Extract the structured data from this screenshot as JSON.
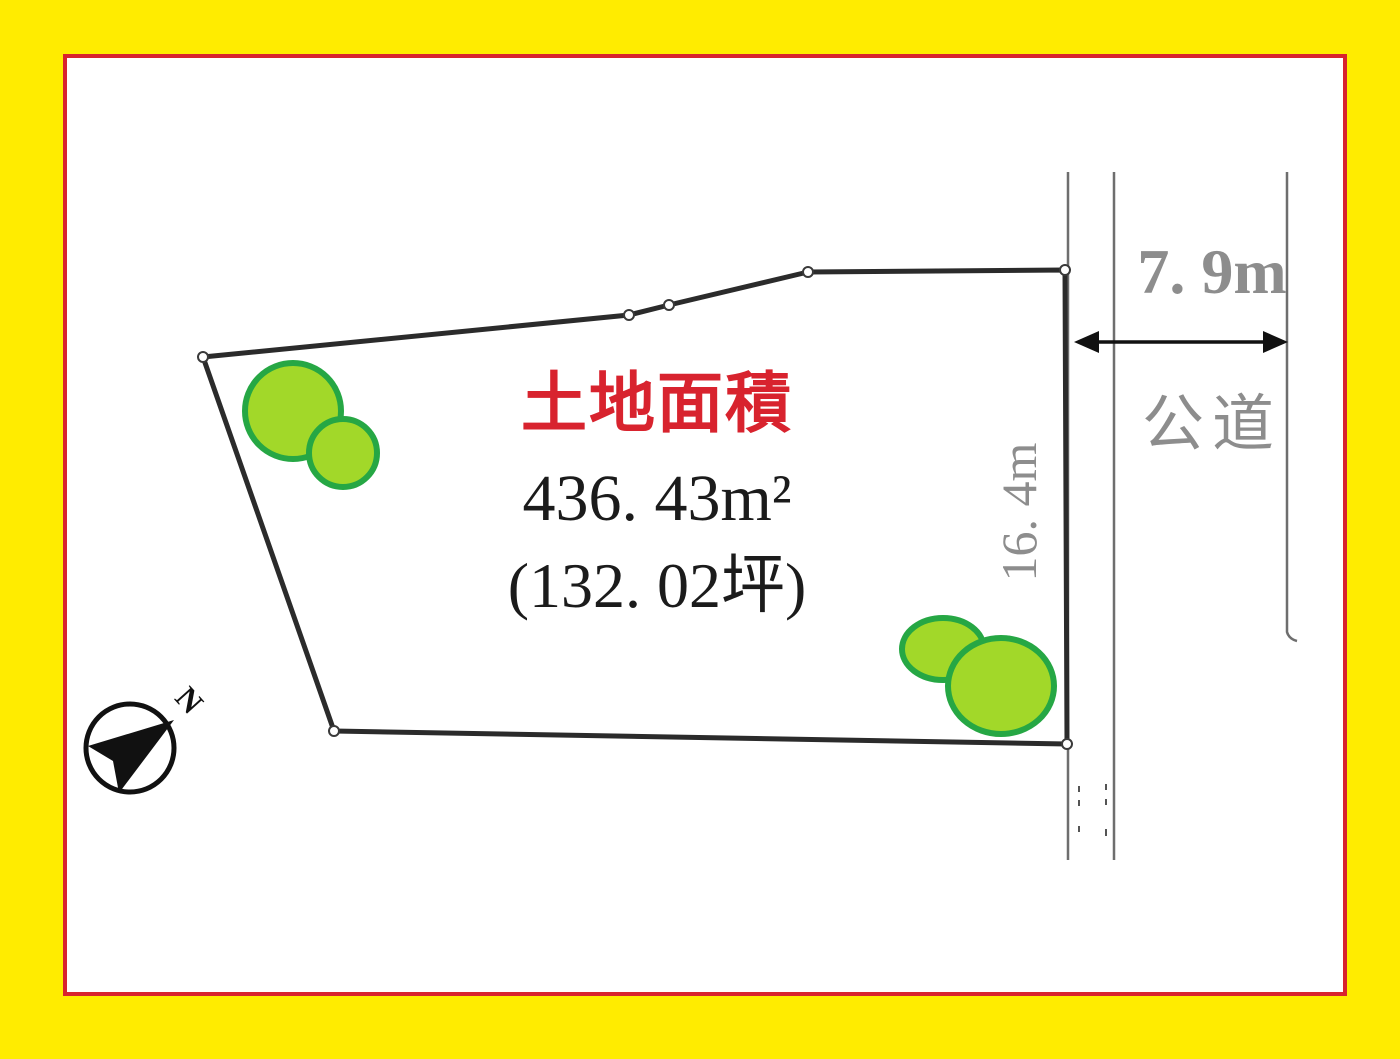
{
  "diagram": {
    "area_title": "土地面積",
    "area_sqm": "436. 43m²",
    "area_tsubo": "(132. 02坪)",
    "road_width": "7. 9m",
    "road_name": "公道",
    "side_length": "16. 4m",
    "compass_north": "N"
  },
  "colors": {
    "frame_yellow": "#ffec00",
    "border_red": "#d8232e",
    "title_red": "#d8232e",
    "body_black": "#1b1b1b",
    "dim_gray": "#8d8d8d",
    "plot_line": "#2b2b2b",
    "road_line": "#6e6e6e",
    "tree_fill": "#a2d829",
    "tree_stroke": "#26a744"
  }
}
